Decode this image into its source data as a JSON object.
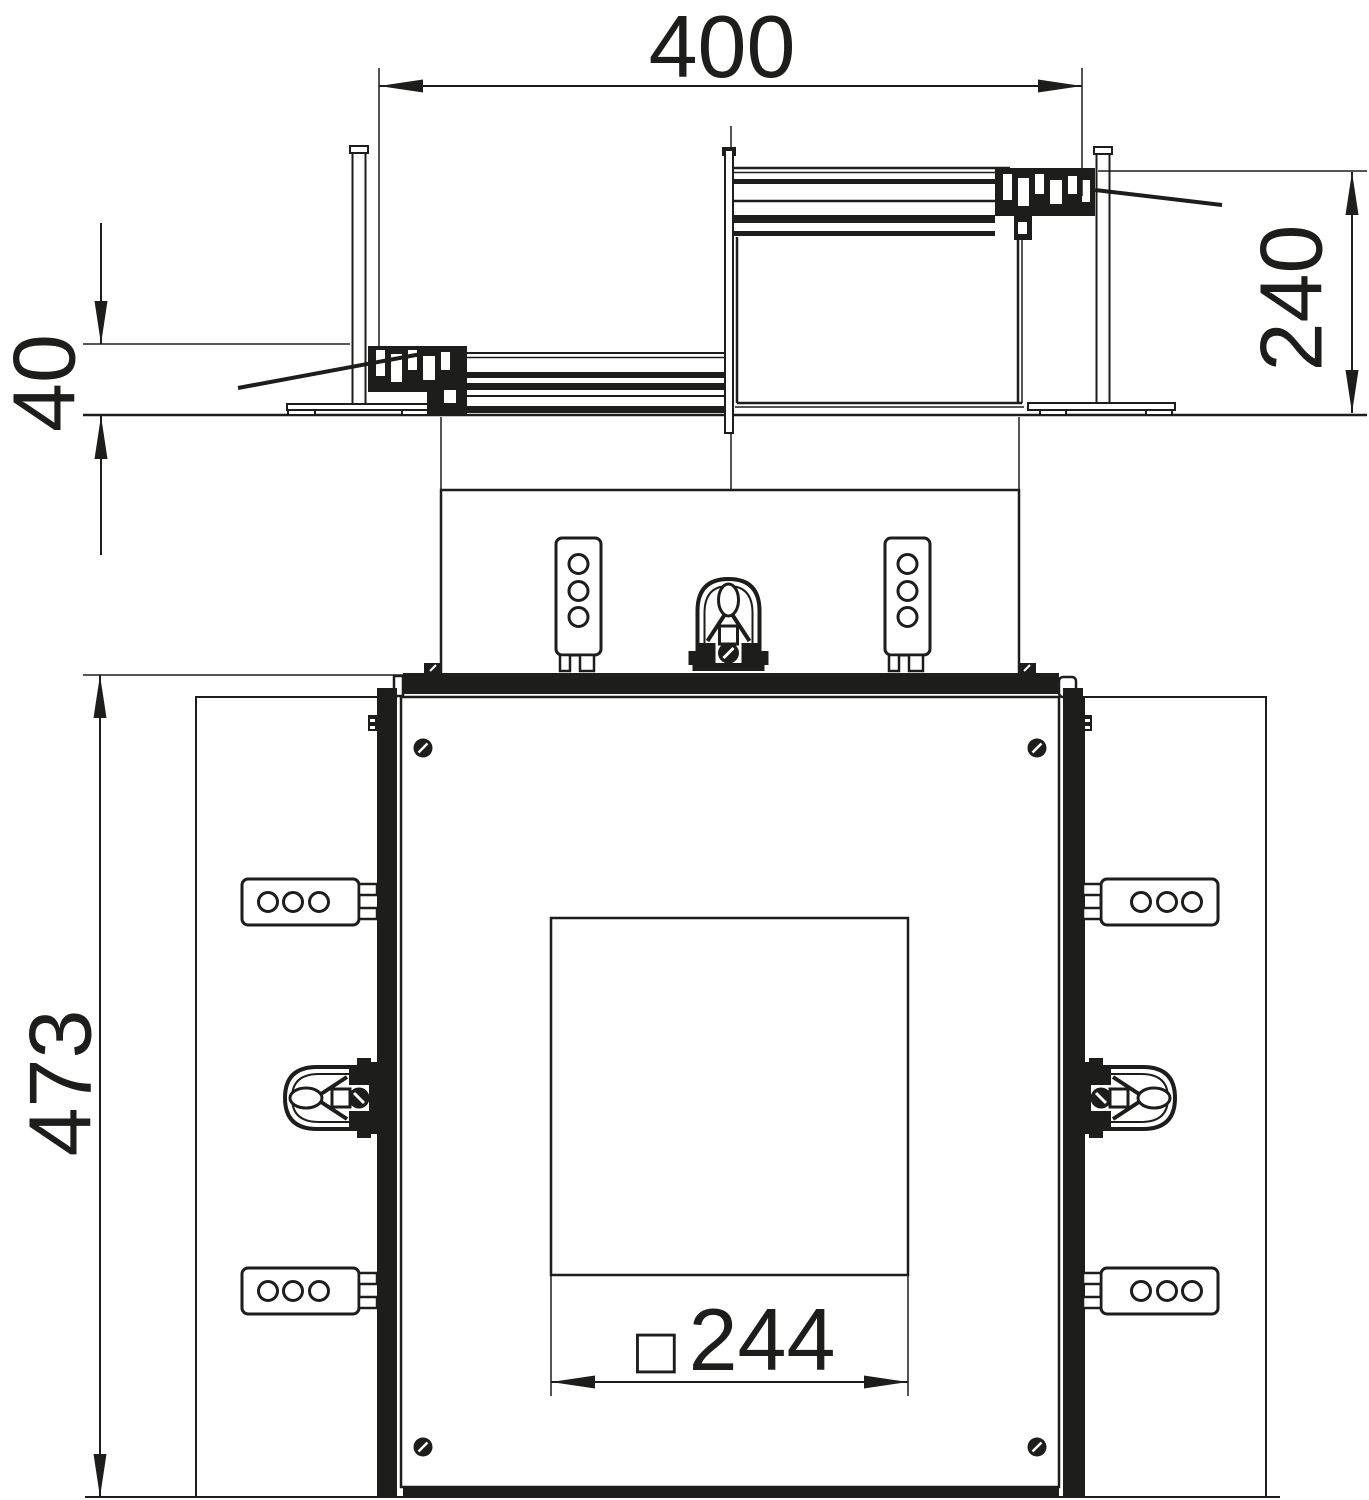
{
  "drawing": {
    "type": "technical-dimension-drawing",
    "dimensions": {
      "overall_width": "400",
      "floor_recess_height": "40",
      "unit_height": "240",
      "plan_height": "473",
      "cutout_size": "244",
      "cutout_prefix": "□"
    },
    "colors": {
      "line": "#1d1d1b",
      "background": "#ffffff"
    }
  }
}
